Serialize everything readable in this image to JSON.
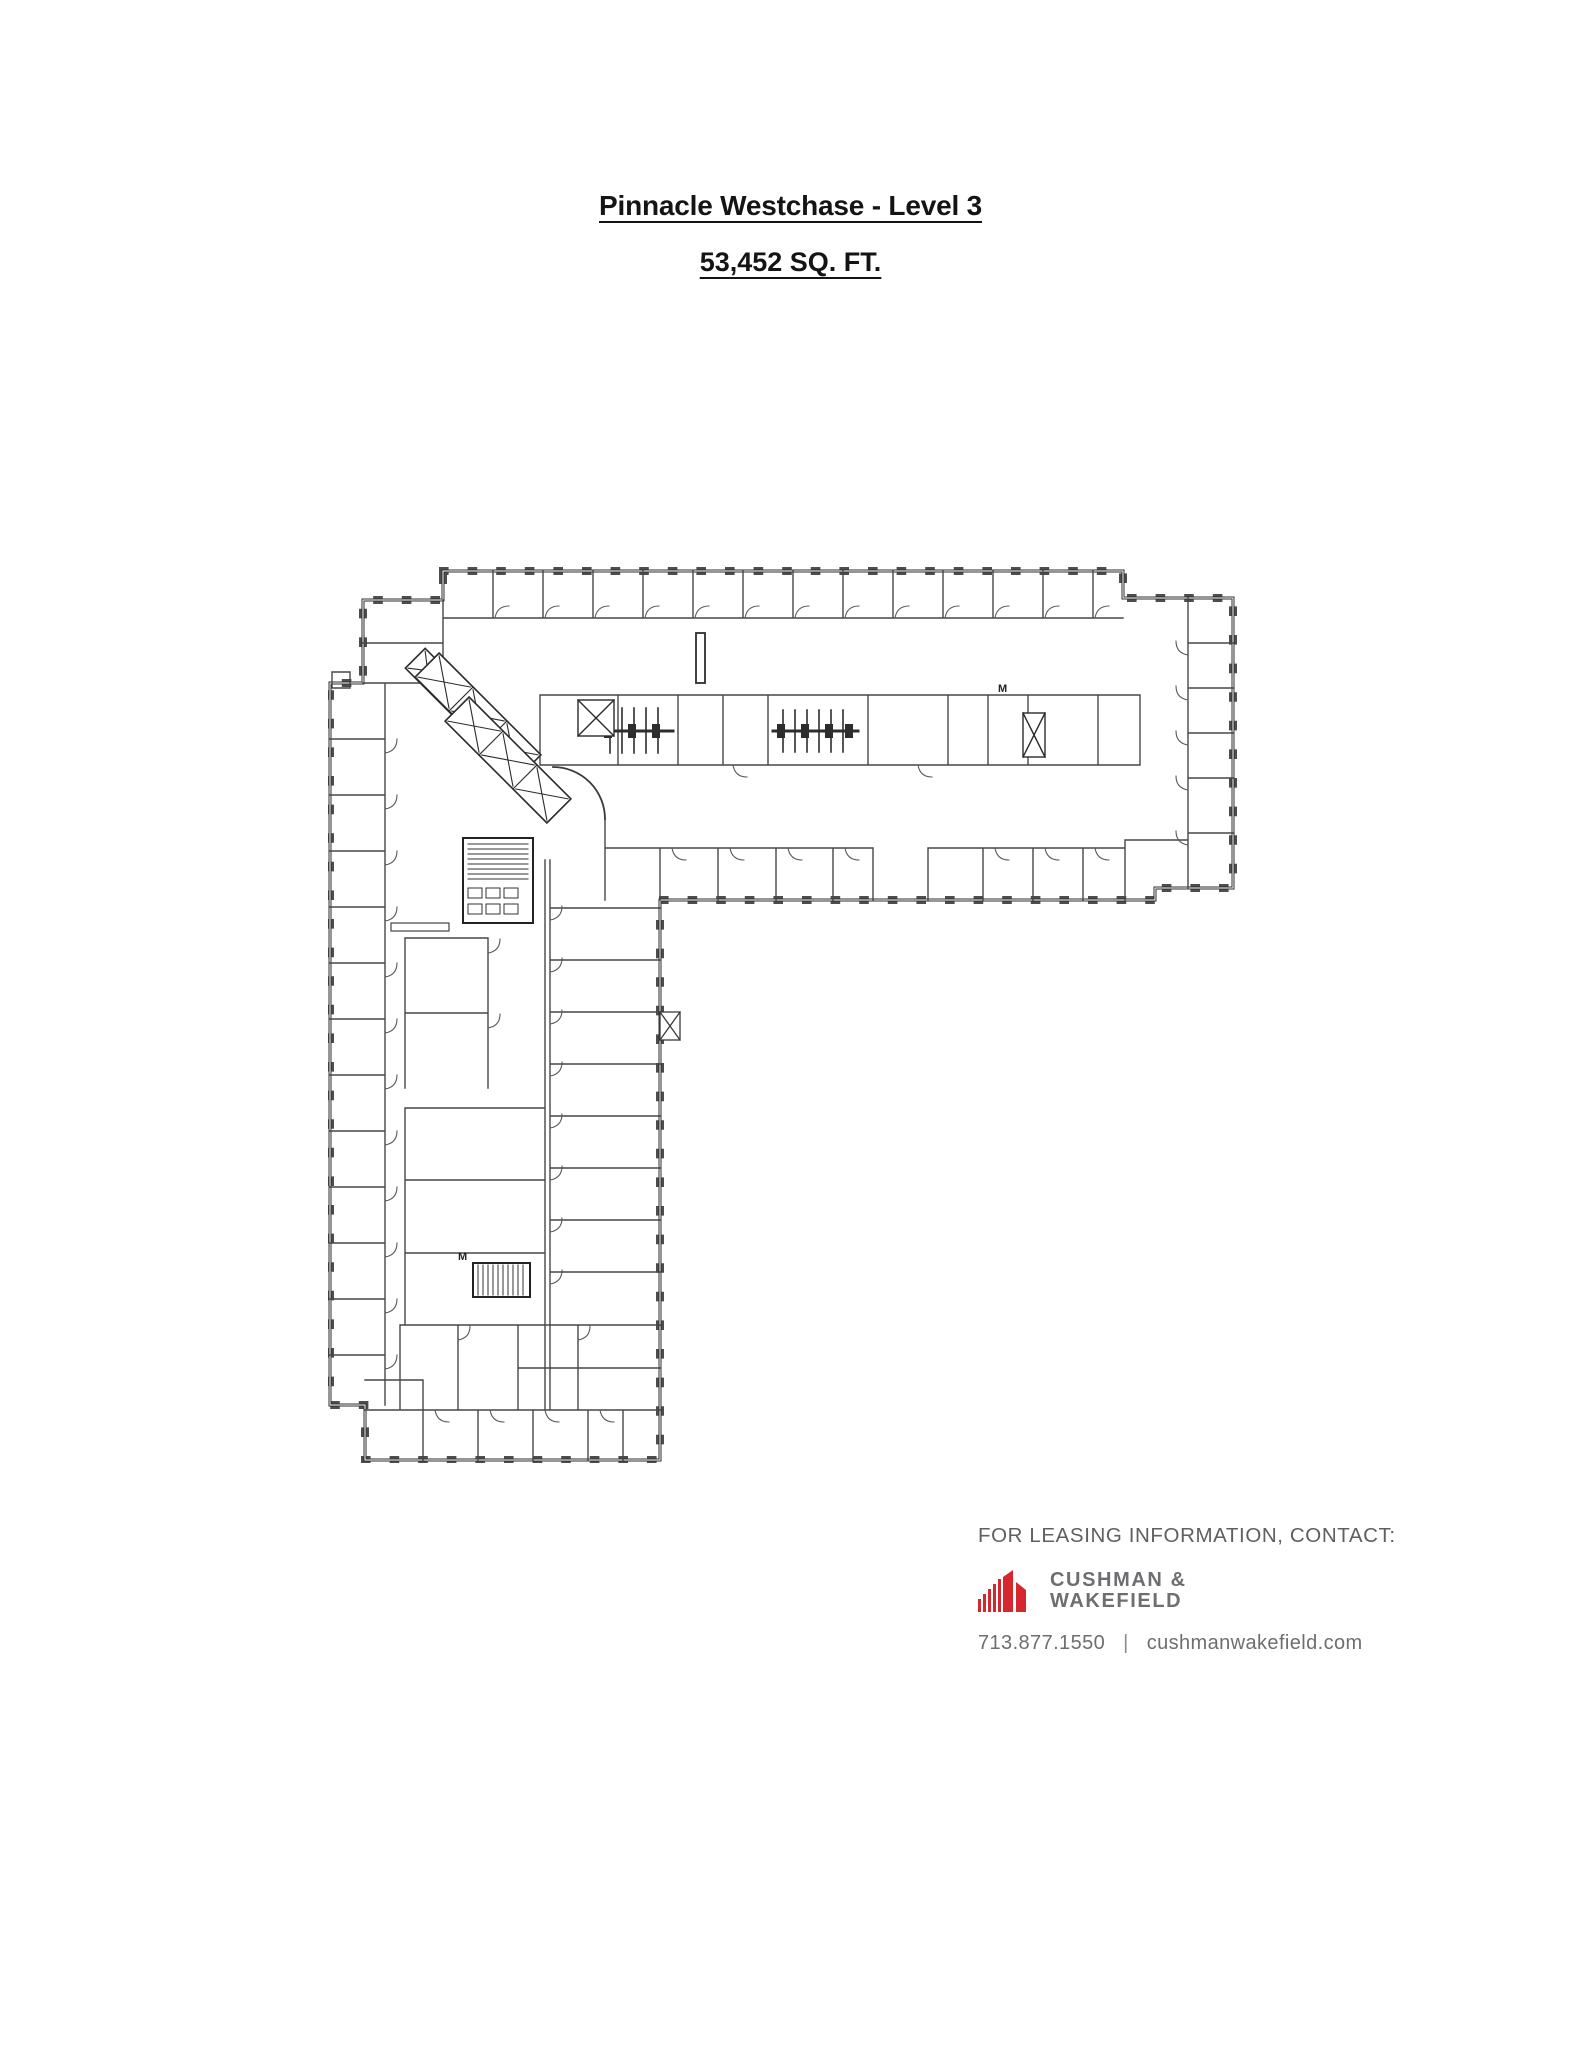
{
  "page": {
    "title": "Pinnacle Westchase - Level 3",
    "subtitle": "53,452 SQ. FT."
  },
  "floor_plan": {
    "labels": [
      "M",
      "M"
    ]
  },
  "contact": {
    "heading": "FOR LEASING INFORMATION, CONTACT:",
    "logo_line1": "CUSHMAN &",
    "logo_line2": "WAKEFIELD",
    "phone": "713.877.1550",
    "separator": "|",
    "website": "cushmanwakefield.com"
  },
  "colors": {
    "brand_red": "#d7272e",
    "logo_gray": "#6d6e71",
    "heading_gray": "#5e5f61",
    "plan_line_dark": "#2e2e2e",
    "plan_line_thin": "#4a4a4a"
  }
}
